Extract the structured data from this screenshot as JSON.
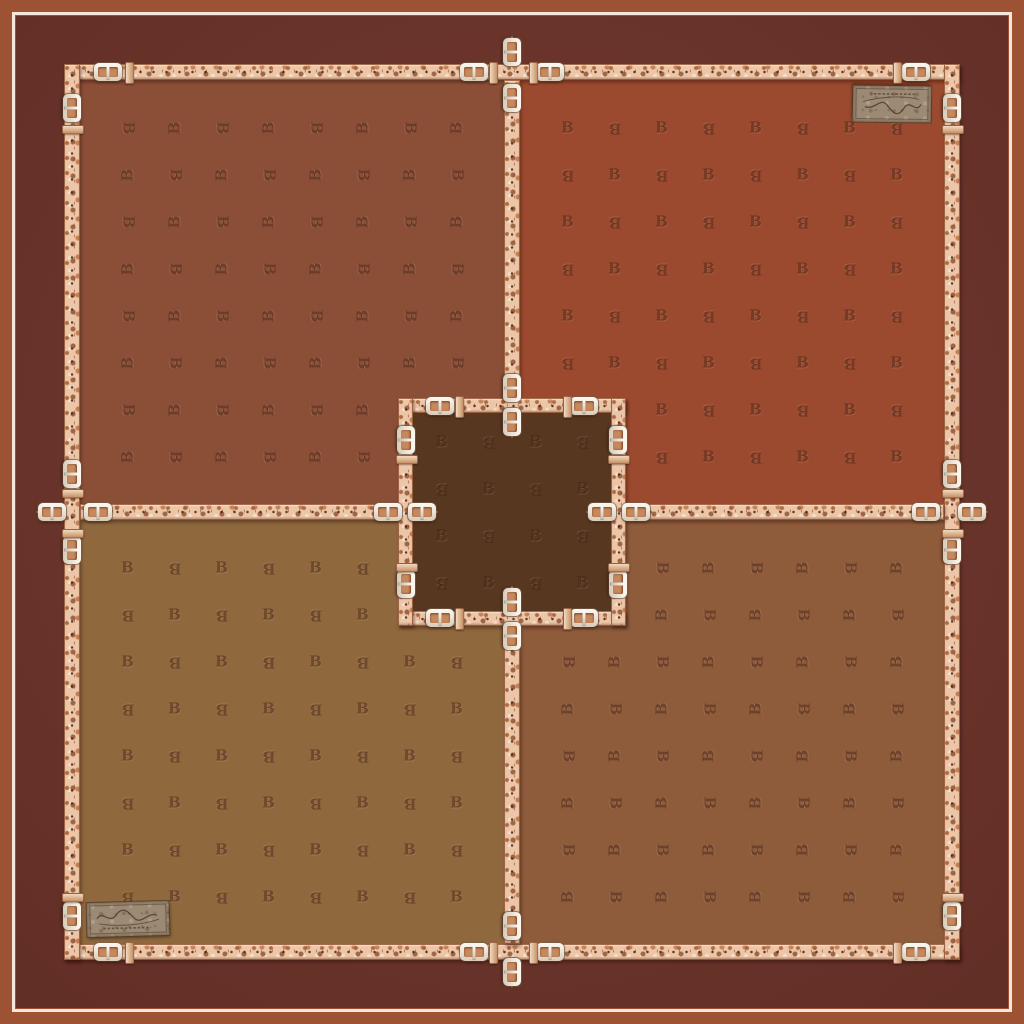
{
  "artwork": {
    "kind": "scarf-textile-design",
    "description": "Square scarf print with belt-and-buckle strap borders, four brown quadrants, a dark center square, tone-on-tone monogram letters and stamped leather signature patches",
    "monogram_letter": "B"
  },
  "colors": {
    "outer_edge": "#9C5233",
    "pinstripe": "#F2E7DA",
    "frame": "#6D352B",
    "quadrant_top_left": "#8B4F37",
    "quadrant_top_right": "#9B4A2F",
    "quadrant_bottom_left": "#8F683E",
    "quadrant_bottom_right": "#8E5B3B",
    "center_square": "#573720",
    "belt_leather": "#EDC6A8",
    "buckle_metal": "#F3ECE1",
    "patch_leather": "#9C8A74",
    "patch_ink": "#4A3826",
    "monogram_ink": "rgba(55,20,6,0.45)"
  },
  "pattern": {
    "monogram_letter": "B",
    "quadrant_grid": {
      "cols": 8,
      "rows": 8,
      "pitch_px": 47
    },
    "center_grid": {
      "cols": 4,
      "rows": 4,
      "pitch_px": 47
    },
    "orientation": {
      "top_left": "rotated-90",
      "top_right": "upright",
      "bottom_left": "upright",
      "bottom_right": "rotated-90",
      "center": "upright"
    }
  },
  "patches": [
    {
      "id": "top-right",
      "content": "script-signature-stamp",
      "text_legible": false,
      "orientation": "rotated-180"
    },
    {
      "id": "bottom-left",
      "content": "script-signature-stamp",
      "text_legible": false,
      "orientation": "upright"
    }
  ]
}
